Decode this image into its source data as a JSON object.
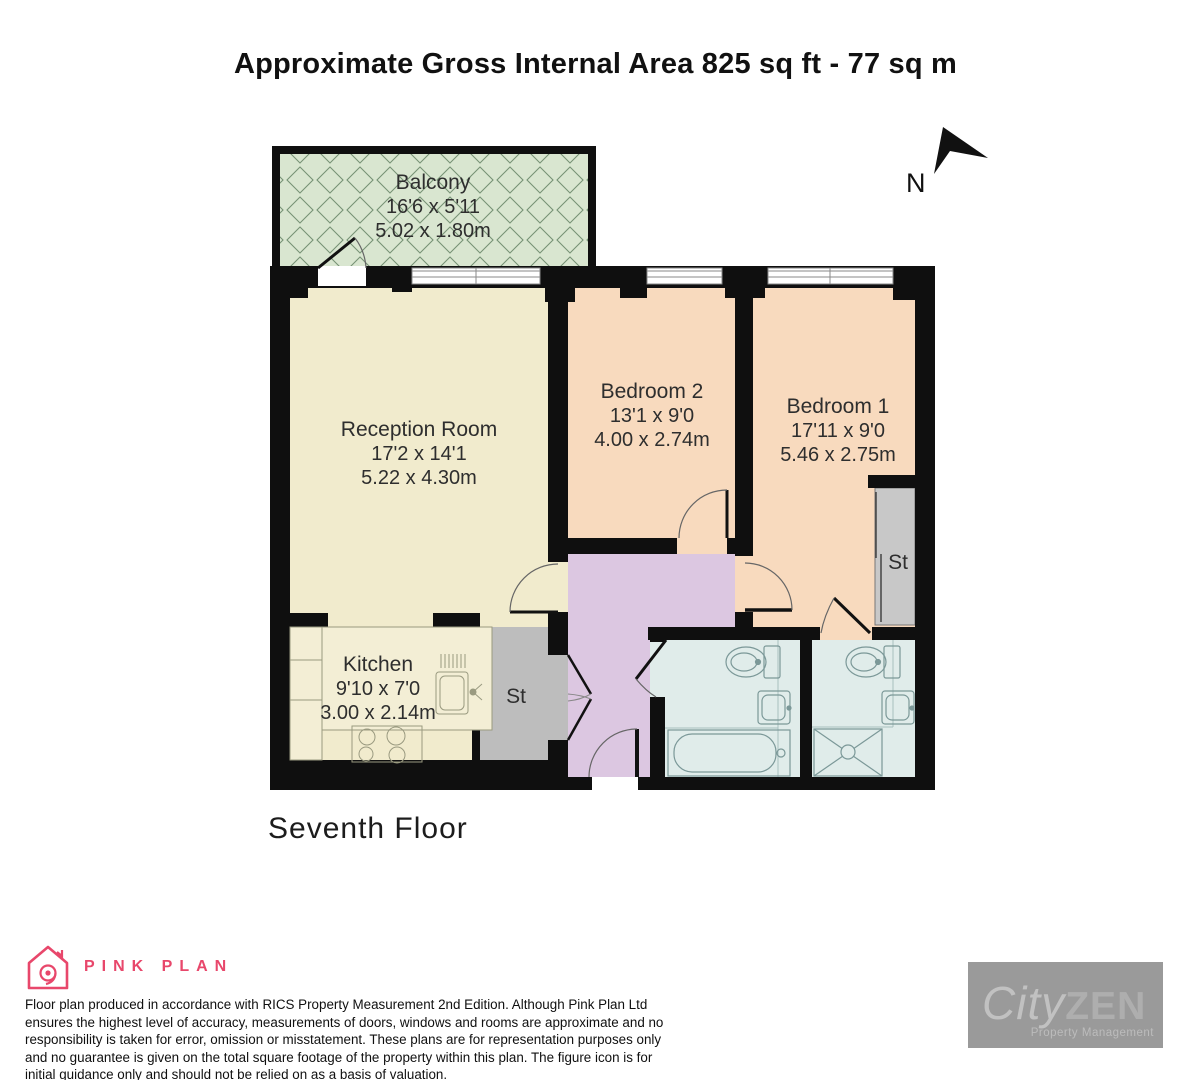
{
  "title": "Approximate Gross Internal Area 825 sq ft - 77 sq m",
  "floor_label": "Seventh Floor",
  "compass": {
    "label": "N"
  },
  "rooms": {
    "balcony": {
      "name": "Balcony",
      "dims_ft": "16'6 x 5'11",
      "dims_m": "5.02 x 1.80m"
    },
    "reception": {
      "name": "Reception Room",
      "dims_ft": "17'2 x 14'1",
      "dims_m": "5.22 x 4.30m"
    },
    "bedroom2": {
      "name": "Bedroom 2",
      "dims_ft": "13'1 x 9'0",
      "dims_m": "4.00 x 2.74m"
    },
    "bedroom1": {
      "name": "Bedroom 1",
      "dims_ft": "17'11 x 9'0",
      "dims_m": "5.46 x 2.75m"
    },
    "kitchen": {
      "name": "Kitchen",
      "dims_ft": "9'10 x 7'0",
      "dims_m": "3.00 x 2.14m"
    },
    "store_hall": {
      "name": "St"
    },
    "store_bedroom": {
      "name": "St"
    }
  },
  "branding": {
    "pink_plan": {
      "name": "PINK PLAN"
    },
    "cityzen": {
      "word1": "City",
      "word2": "ZEN",
      "tagline": "Property Management"
    }
  },
  "disclaimer": "Floor plan produced in accordance with RICS Property Measurement 2nd Edition. Although Pink Plan Ltd ensures the highest level of accuracy, measurements of doors, windows and rooms are approximate and no responsibility is taken for error, omission or misstatement. These plans are for representation purposes only and no guarantee is given on the total square footage of the property within this plan. The figure icon is for initial guidance only and should not be relied on as a basis of valuation.",
  "colors": {
    "wall": "#0f0f0f",
    "reception_kitchen_fill": "#f1ebcd",
    "bedroom_fill": "#f8dabe",
    "hall_fill": "#dcc7e1",
    "bathroom_fill": "#e0ecea",
    "store_fill": "#bdbdbd",
    "balcony_fill": "#d9e6d0",
    "balcony_lattice": "#5d7d5d",
    "brand_pink": "#e8476b",
    "cityzen_gray": "#9a9a9a"
  }
}
